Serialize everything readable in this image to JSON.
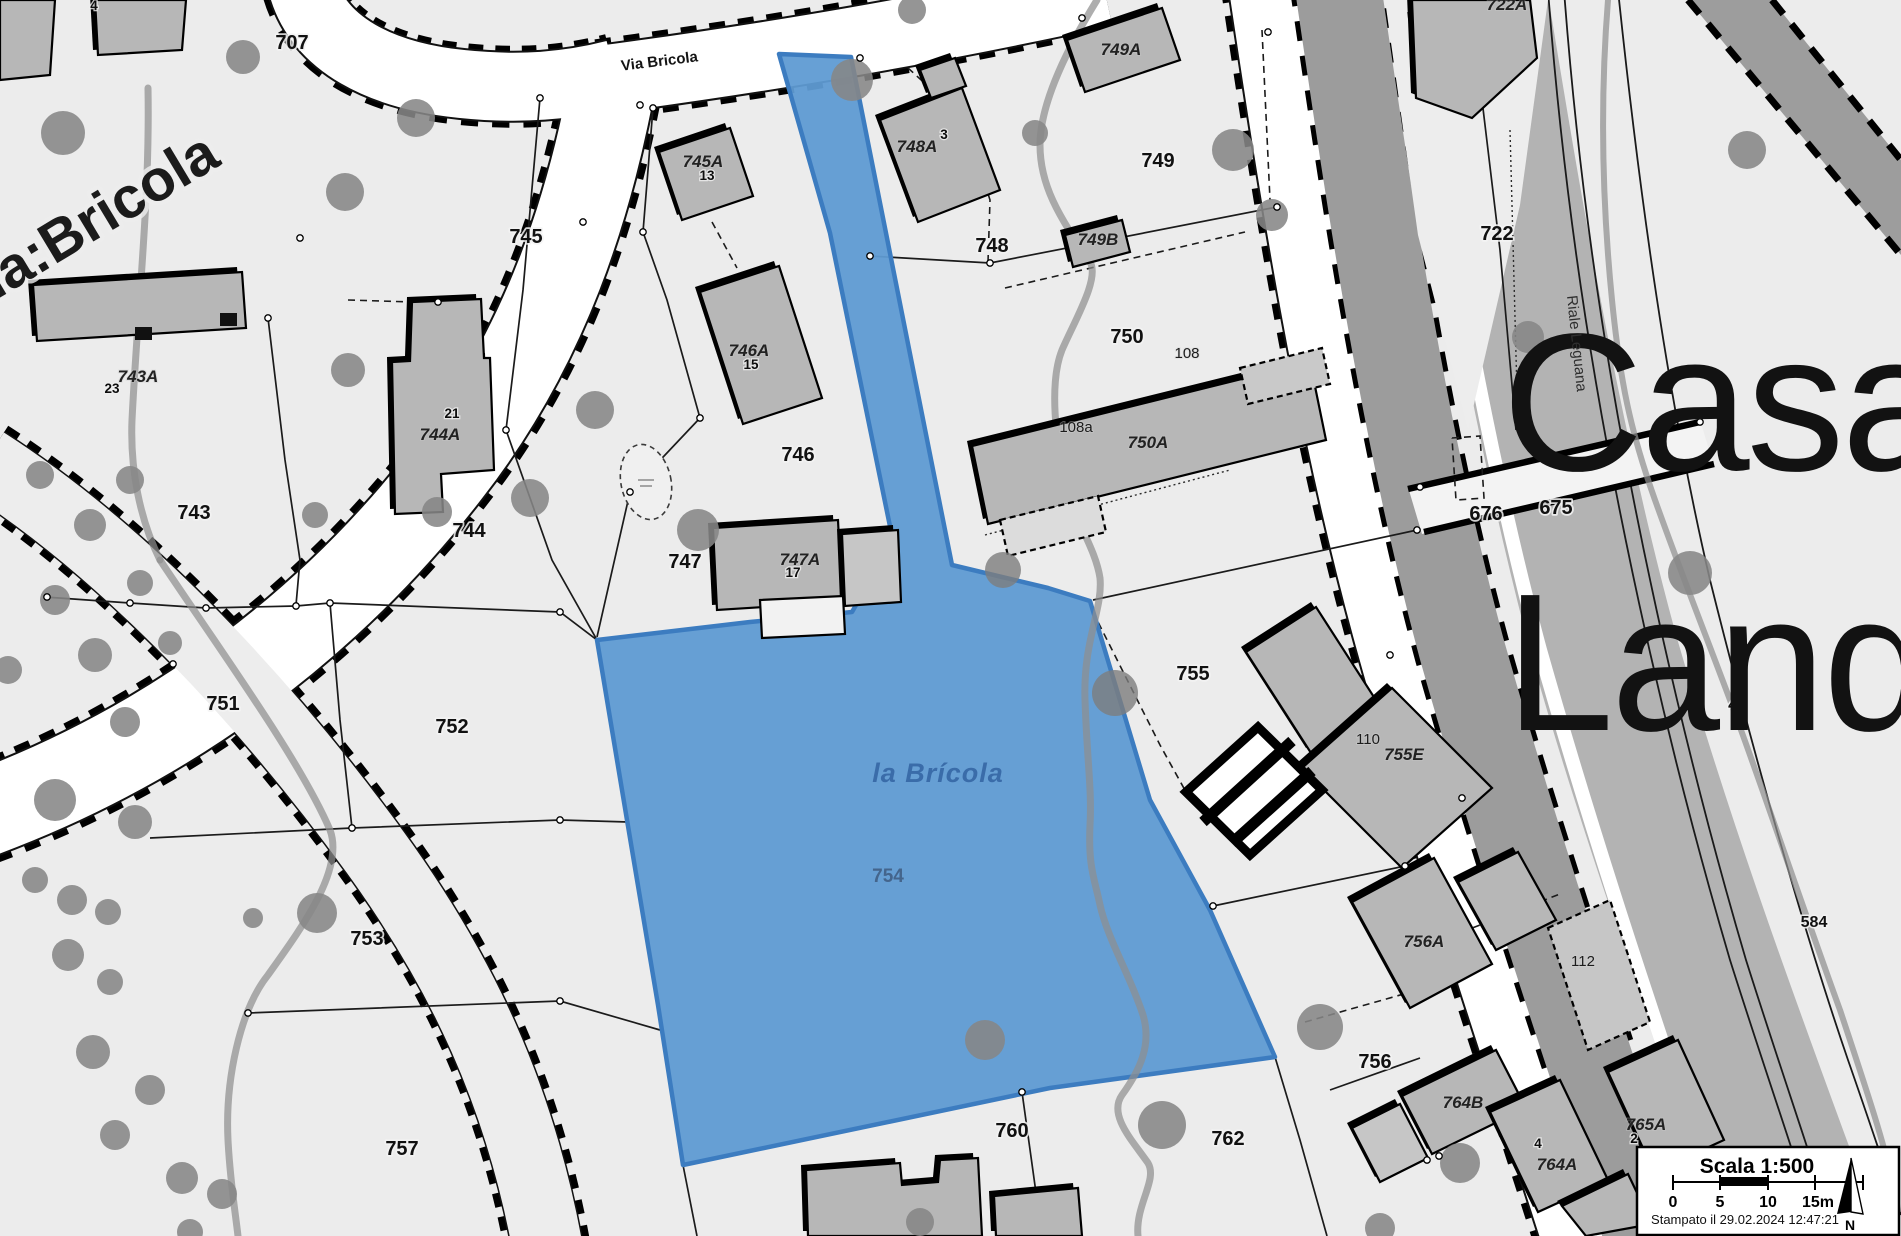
{
  "map": {
    "title": "Cadastral map extract",
    "street_name": "Via Bricola",
    "street_name_large": "ia:Bricola",
    "stream_name": "Riale Leguana",
    "district_names": [
      "Casa",
      "Land"
    ],
    "highlighted_parcel": {
      "id": "754",
      "name": "la Brícola"
    },
    "colors": {
      "background": "#ececec",
      "building": "#b7b7b7",
      "road": "#ffffff",
      "tree": "#868686",
      "highlight_fill": "#5f9bd3",
      "highlight_border": "#3c7cc0",
      "highlight_text": "#3a6ca9"
    },
    "labels": [
      {
        "t": "707",
        "x": 292,
        "y": 49,
        "c": "p"
      },
      {
        "t": "745",
        "x": 526,
        "y": 243,
        "c": "p"
      },
      {
        "t": "746",
        "x": 798,
        "y": 461,
        "c": "p"
      },
      {
        "t": "747",
        "x": 685,
        "y": 568,
        "c": "p"
      },
      {
        "t": "748",
        "x": 992,
        "y": 252,
        "c": "p"
      },
      {
        "t": "749",
        "x": 1158,
        "y": 167,
        "c": "p"
      },
      {
        "t": "750",
        "x": 1127,
        "y": 343,
        "c": "p"
      },
      {
        "t": "751",
        "x": 223,
        "y": 710,
        "c": "p"
      },
      {
        "t": "752",
        "x": 452,
        "y": 733,
        "c": "p"
      },
      {
        "t": "753",
        "x": 367,
        "y": 945,
        "c": "p"
      },
      {
        "t": "755",
        "x": 1193,
        "y": 680,
        "c": "p"
      },
      {
        "t": "756",
        "x": 1375,
        "y": 1068,
        "c": "p"
      },
      {
        "t": "757",
        "x": 402,
        "y": 1155,
        "c": "p"
      },
      {
        "t": "760",
        "x": 1012,
        "y": 1137,
        "c": "p"
      },
      {
        "t": "762",
        "x": 1228,
        "y": 1145,
        "c": "p"
      },
      {
        "t": "743",
        "x": 194,
        "y": 519,
        "c": "p"
      },
      {
        "t": "744",
        "x": 469,
        "y": 537,
        "c": "p"
      },
      {
        "t": "722",
        "x": 1497,
        "y": 240,
        "c": "p"
      },
      {
        "t": "675",
        "x": 1556,
        "y": 514,
        "c": "p"
      },
      {
        "t": "676",
        "x": 1486,
        "y": 520,
        "c": "p"
      },
      {
        "t": "41",
        "x": 1737,
        "y": 710,
        "c": "pm"
      },
      {
        "t": "584",
        "x": 1814,
        "y": 927,
        "c": "pm"
      },
      {
        "t": "754",
        "x": 888,
        "y": 882,
        "c": "bn"
      },
      {
        "t": "la Brícola",
        "x": 938,
        "y": 782,
        "c": "bt"
      },
      {
        "t": "743A",
        "x": 138,
        "y": 382,
        "c": "b"
      },
      {
        "t": "744A",
        "x": 440,
        "y": 440,
        "c": "b"
      },
      {
        "t": "745A",
        "x": 703,
        "y": 167,
        "c": "b"
      },
      {
        "t": "746A",
        "x": 749,
        "y": 356,
        "c": "b"
      },
      {
        "t": "747A",
        "x": 800,
        "y": 565,
        "c": "b"
      },
      {
        "t": "748A",
        "x": 917,
        "y": 152,
        "c": "b"
      },
      {
        "t": "749A",
        "x": 1121,
        "y": 55,
        "c": "b"
      },
      {
        "t": "749B",
        "x": 1098,
        "y": 245,
        "c": "b"
      },
      {
        "t": "750A",
        "x": 1148,
        "y": 448,
        "c": "b"
      },
      {
        "t": "755E",
        "x": 1404,
        "y": 760,
        "c": "b"
      },
      {
        "t": "756A",
        "x": 1424,
        "y": 947,
        "c": "b"
      },
      {
        "t": "764B",
        "x": 1463,
        "y": 1108,
        "c": "b"
      },
      {
        "t": "765A",
        "x": 1646,
        "y": 1130,
        "c": "b"
      },
      {
        "t": "764A",
        "x": 1557,
        "y": 1170,
        "c": "b"
      },
      {
        "t": "722A",
        "x": 1507,
        "y": 10,
        "c": "b"
      },
      {
        "t": "4",
        "x": 94,
        "y": 10,
        "c": "h"
      },
      {
        "t": "23",
        "x": 112,
        "y": 393,
        "c": "h"
      },
      {
        "t": "21",
        "x": 452,
        "y": 418,
        "c": "h"
      },
      {
        "t": "13",
        "x": 707,
        "y": 180,
        "c": "h"
      },
      {
        "t": "15",
        "x": 751,
        "y": 369,
        "c": "h"
      },
      {
        "t": "17",
        "x": 793,
        "y": 577,
        "c": "h"
      },
      {
        "t": "3",
        "x": 944,
        "y": 139,
        "c": "h"
      },
      {
        "t": "2",
        "x": 1634,
        "y": 1143,
        "c": "h"
      },
      {
        "t": "4",
        "x": 1538,
        "y": 1148,
        "c": "h"
      },
      {
        "t": "108",
        "x": 1187,
        "y": 358,
        "c": "m"
      },
      {
        "t": "108a",
        "x": 1076,
        "y": 432,
        "c": "m"
      },
      {
        "t": "110",
        "x": 1368,
        "y": 744,
        "c": "m"
      },
      {
        "t": "112",
        "x": 1583,
        "y": 966,
        "c": "m"
      },
      {
        "t": "Via Bricola",
        "x": 660,
        "y": 66,
        "c": "s",
        "rot": -7
      },
      {
        "t": "ia:Bricola",
        "x": -4,
        "y": 300,
        "c": "sb",
        "rot": -31
      },
      {
        "t": "Casa",
        "x": 1502,
        "y": 470,
        "c": "d"
      },
      {
        "t": "Land",
        "x": 1505,
        "y": 730,
        "c": "d"
      },
      {
        "t": "Riale Leguana",
        "x": 1572,
        "y": 344,
        "c": "r",
        "rot": 84
      }
    ]
  },
  "scale_box": {
    "title": "Scala 1:500",
    "ticks": [
      "0",
      "5",
      "10",
      "15m"
    ],
    "stamp": "Stampato il 29.02.2024 12:47:21",
    "north_label": "N"
  }
}
